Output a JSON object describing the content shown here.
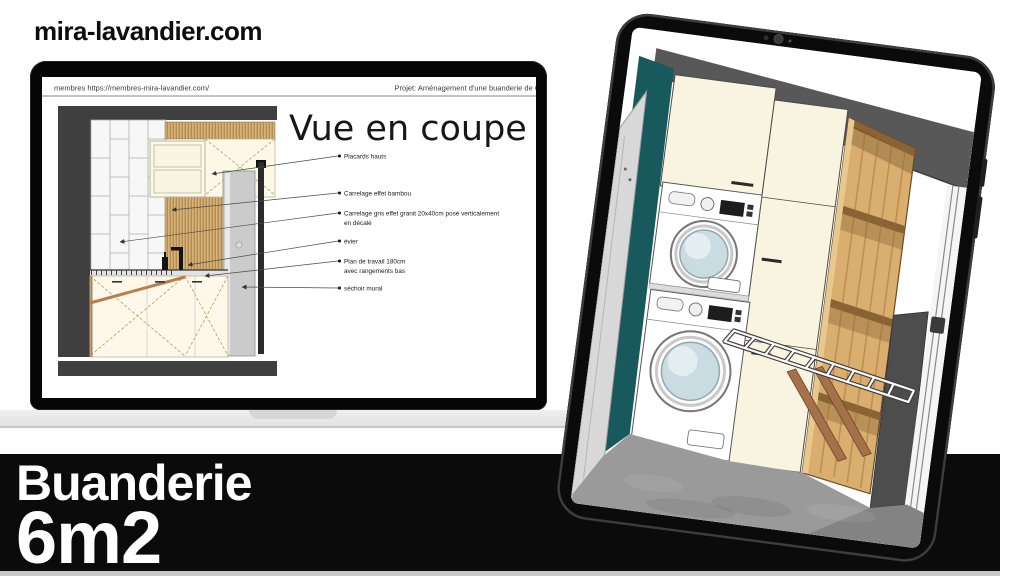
{
  "branding": {
    "site_url": "mira-lavandier.com"
  },
  "banner": {
    "title_line1": "Buanderie",
    "title_line2": "6m2",
    "bg_color": "#0b0b0b",
    "text_color": "#ffffff"
  },
  "laptop": {
    "browser_header": {
      "left_text": "membres https://membres-mira-lavandier.com/",
      "right_text": "Projet: Aménagement d'une buanderie de 6"
    },
    "slide": {
      "title": "Vue en coupe",
      "annotations": [
        {
          "lines": [
            "Placards hauts"
          ]
        },
        {
          "lines": [
            "Carrelage effet bambou"
          ]
        },
        {
          "lines": [
            "Carrelage gris effet granit 20x40cm posé verticalement",
            "en décalé"
          ]
        },
        {
          "lines": [
            "évier"
          ]
        },
        {
          "lines": [
            "Plan de travail 180cm",
            "avec rangements bas"
          ]
        },
        {
          "lines": [
            "séchoir mural"
          ]
        }
      ]
    }
  },
  "tablet": {
    "colors": {
      "wall_teal": "#17595d",
      "cabinet_cream": "#f8f4e0",
      "wood_shelf": "#d9ae6e",
      "floor_gray": "#9a9a9a"
    }
  }
}
